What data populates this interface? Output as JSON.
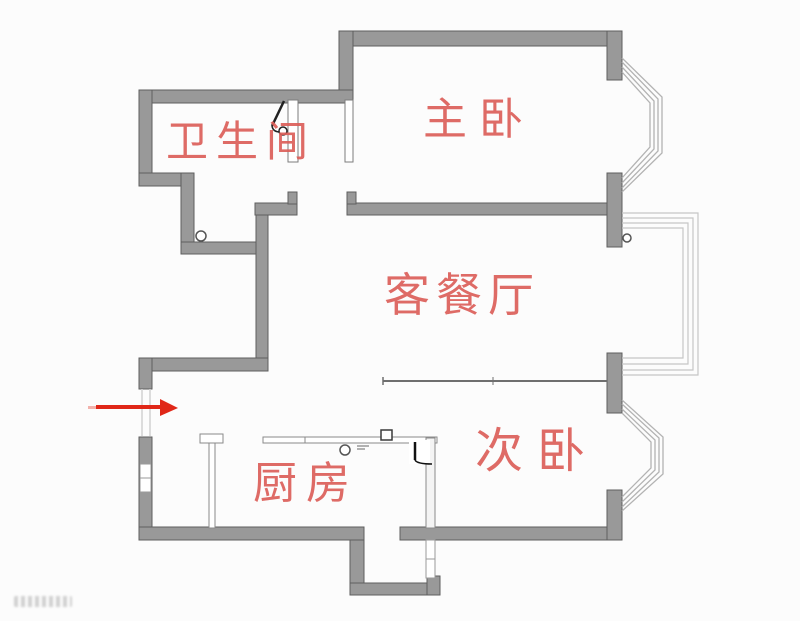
{
  "floor_plan": {
    "rooms": {
      "bathroom": {
        "label": "卫生间"
      },
      "master_bedroom": {
        "label": "主卧"
      },
      "living_dining": {
        "label": "客餐厅"
      },
      "second_bedroom": {
        "label": "次卧"
      },
      "kitchen": {
        "label": "厨房"
      }
    },
    "entrance_arrow": {
      "direction": "right"
    },
    "colors": {
      "wall": "#999999",
      "wall_edge": "#5e5e5e",
      "room_label": "#dc5f5a",
      "arrow": "#e02718",
      "window_line": "#b3b3b3",
      "balcony_line": "#c6c6c6",
      "background": "#fcfcfc"
    }
  }
}
